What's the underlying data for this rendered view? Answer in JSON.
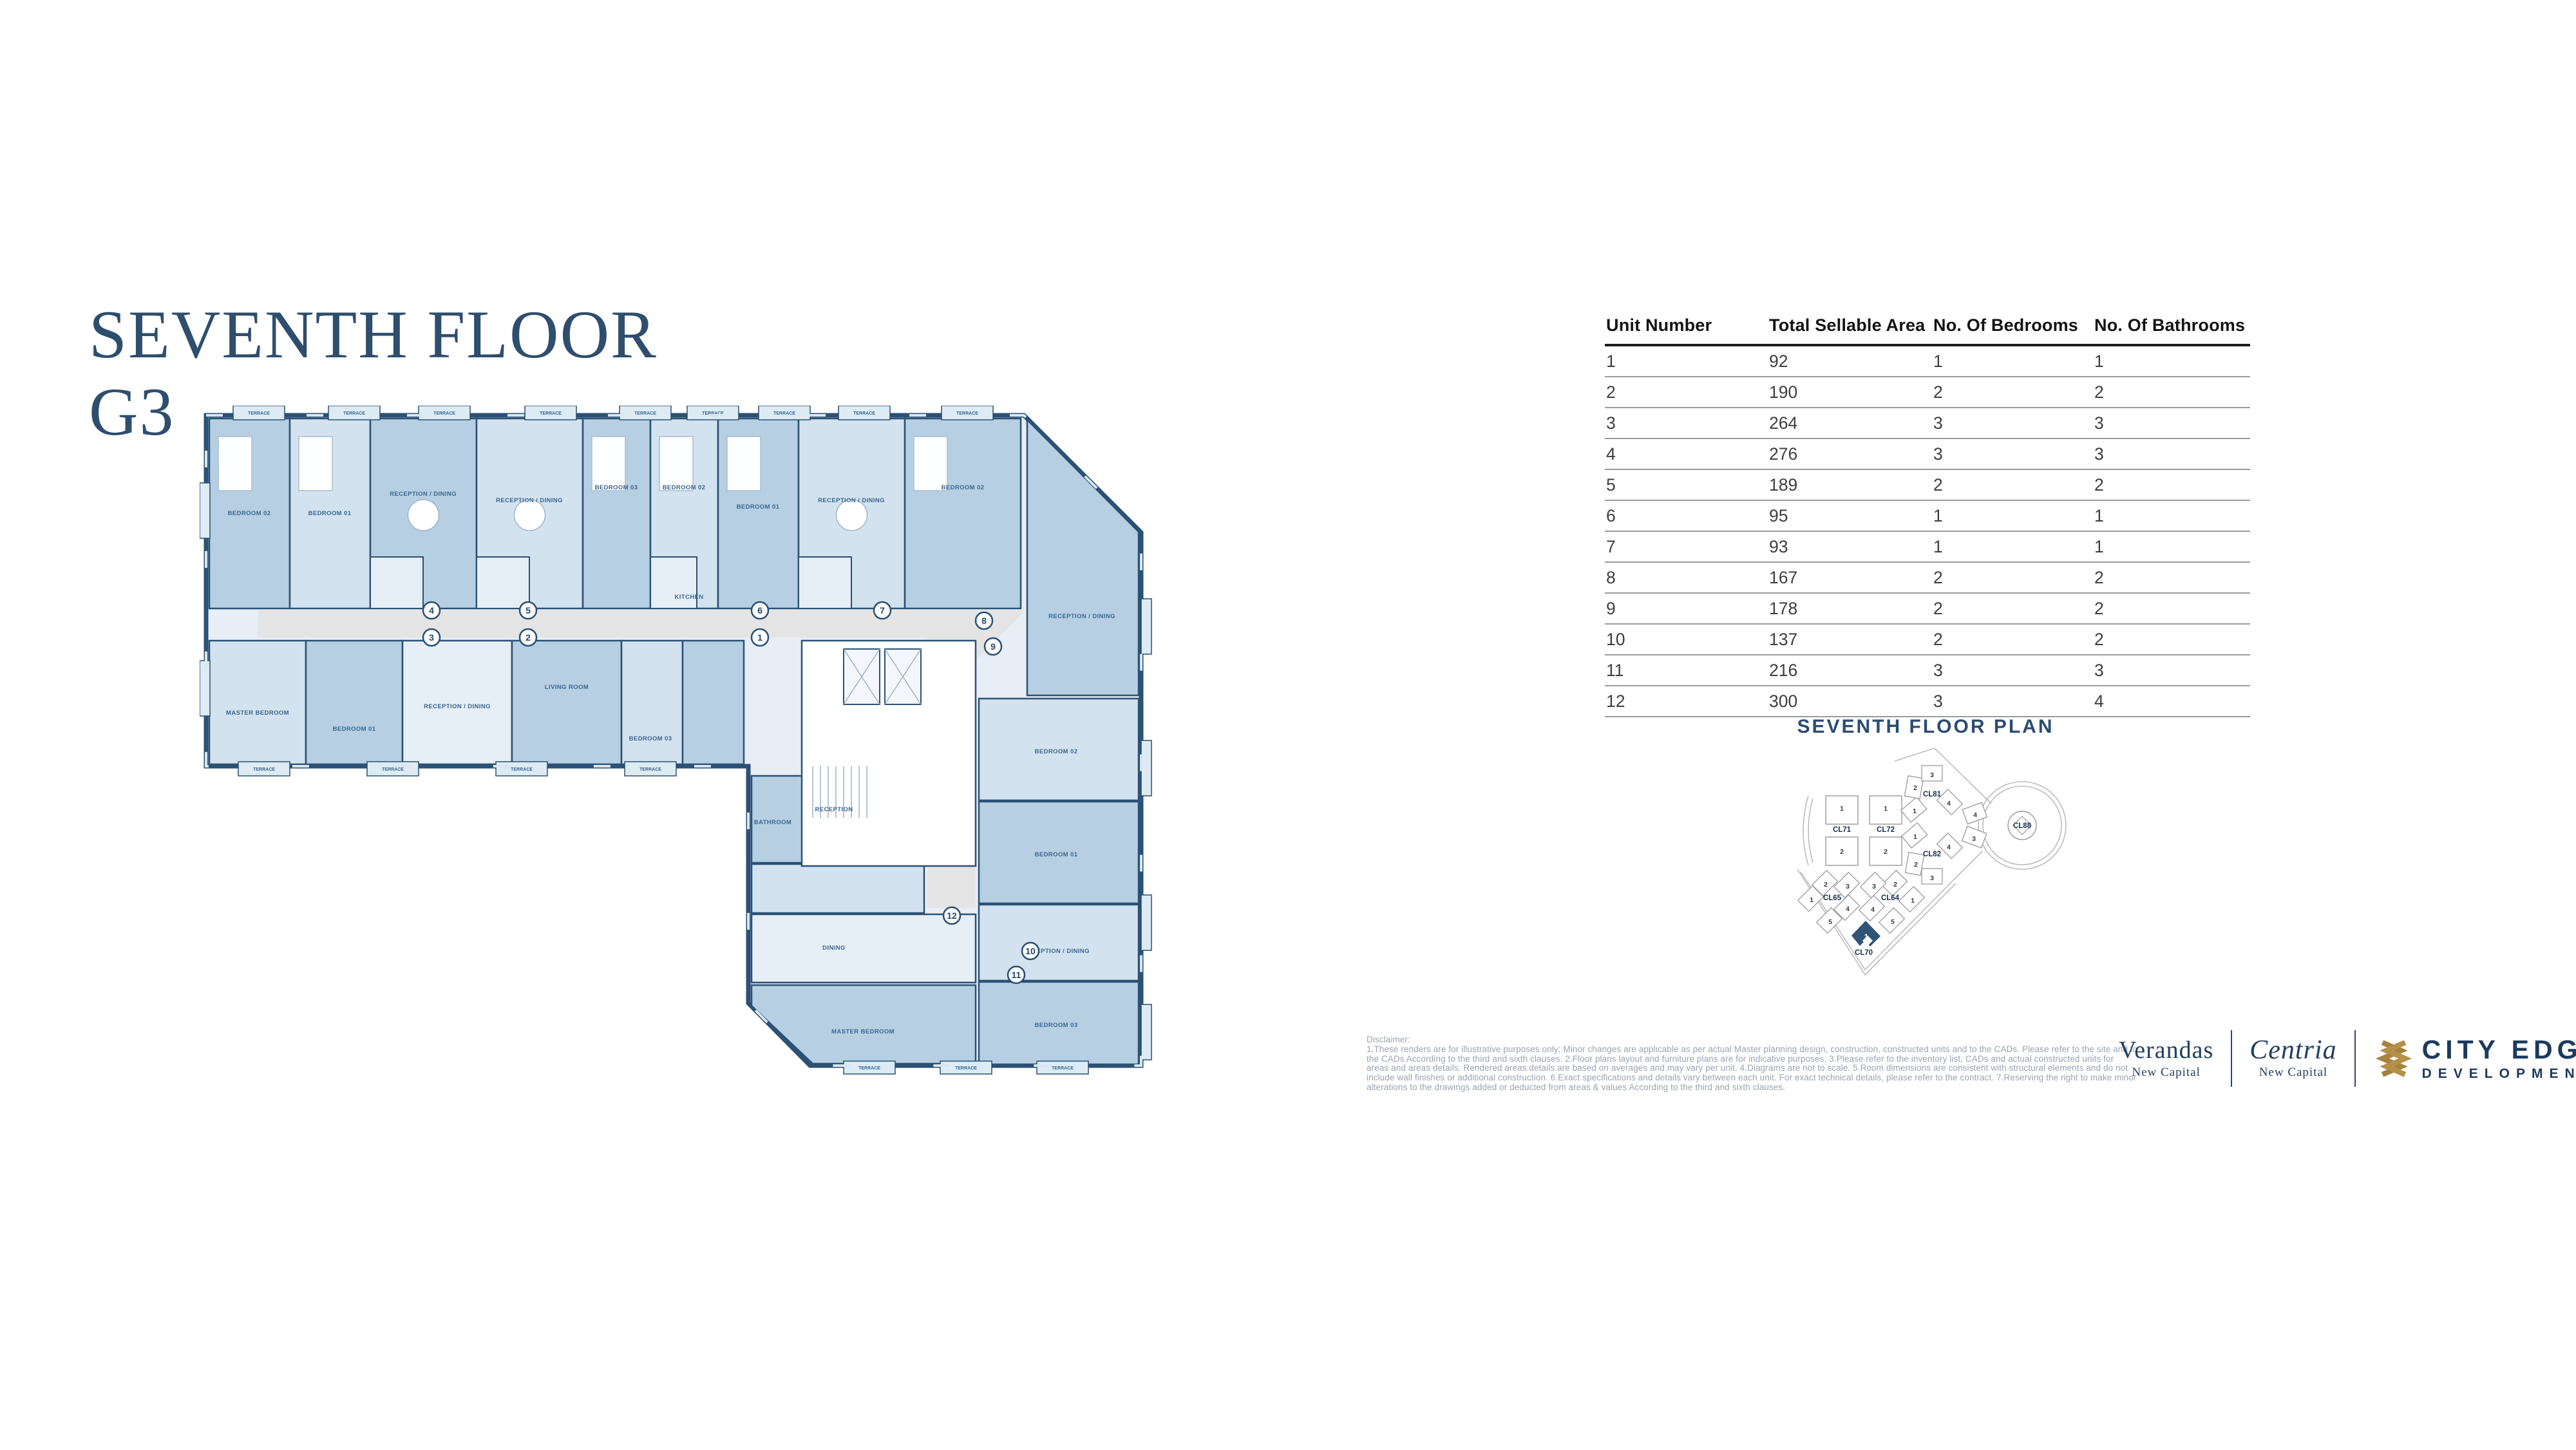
{
  "page": {
    "title_line1": "SEVENTH FLOOR",
    "title_line2": "G3"
  },
  "table": {
    "columns": [
      "Unit Number",
      "Total Sellable Area",
      "No. Of Bedrooms",
      "No. Of Bathrooms"
    ],
    "rows": [
      [
        "1",
        "92",
        "1",
        "1"
      ],
      [
        "2",
        "190",
        "2",
        "2"
      ],
      [
        "3",
        "264",
        "3",
        "3"
      ],
      [
        "4",
        "276",
        "3",
        "3"
      ],
      [
        "5",
        "189",
        "2",
        "2"
      ],
      [
        "6",
        "95",
        "1",
        "1"
      ],
      [
        "7",
        "93",
        "1",
        "1"
      ],
      [
        "8",
        "167",
        "2",
        "2"
      ],
      [
        "9",
        "178",
        "2",
        "2"
      ],
      [
        "10",
        "137",
        "2",
        "2"
      ],
      [
        "11",
        "216",
        "3",
        "3"
      ],
      [
        "12",
        "300",
        "3",
        "4"
      ]
    ]
  },
  "plan": {
    "unit_markers": [
      "1",
      "2",
      "3",
      "4",
      "5",
      "6",
      "7",
      "8",
      "9",
      "10",
      "11",
      "12"
    ],
    "terrace_label": "TERRACE",
    "room_labels": [
      "BEDROOM 02",
      "BEDROOM 01",
      "RECEPTION / DINING",
      "RECEPTION / DINING",
      "BEDROOM 03",
      "BEDROOM 02",
      "BEDROOM 01",
      "RECEPTION / DINING",
      "BEDROOM 02",
      "RECEPTION / DINING",
      "MASTER BEDROOM",
      "BEDROOM 01",
      "RECEPTION / DINING",
      "LIVING ROOM",
      "BEDROOM 03",
      "KITCHEN",
      "BATHROOM",
      "RECEPTION",
      "DINING",
      "MASTER BEDROOM",
      "BEDROOM 02",
      "BEDROOM 01",
      "RECEPTION / DINING",
      "BEDROOM 03"
    ]
  },
  "keymap": {
    "heading": "SEVENTH FLOOR PLAN",
    "clusters": [
      {
        "id": "CL71",
        "units": [
          "1",
          "2"
        ]
      },
      {
        "id": "CL72",
        "units": [
          "1",
          "2"
        ]
      },
      {
        "id": "CL81",
        "units": [
          "1",
          "2",
          "3",
          "4"
        ]
      },
      {
        "id": "CL82",
        "units": [
          "1",
          "2",
          "3",
          "4"
        ]
      },
      {
        "id": "CL88",
        "units": [
          "3",
          "4"
        ]
      },
      {
        "id": "CL65",
        "units": [
          "1",
          "2",
          "3",
          "4",
          "5"
        ]
      },
      {
        "id": "CL64",
        "units": [
          "1",
          "2",
          "3",
          "4",
          "5"
        ]
      },
      {
        "id": "CL70",
        "units": [
          "1"
        ],
        "highlighted": true
      }
    ]
  },
  "disclaimer": {
    "label": "Disclaimer:",
    "text": "1.These renders are for illustrative purposes only; Minor changes are applicable as per actual Master planning design, construction, constructed units and to the CADs. Please refer to the site and to the CADs According to the third and sixth clauses. 2.Floor plans layout and furniture plans are for indicative purposes. 3.Please refer to the inventory list, CADs and actual constructed units for areas and areas details. Rendered areas details are based on averages and may vary per unit. 4.Diagrams are not to scale. 5.Room dimensions are consistent with structural elements and do not include wall finishes or additional construction. 6.Exact specifications and details vary between each unit. For exact technical details, please refer to the contract. 7.Reserving the right to make minor alterations to the drawings added or deducted from areas & values According to the third and sixth clauses."
  },
  "logos": {
    "verandas": {
      "name": "Verandas",
      "subtitle": "New Capital"
    },
    "centria": {
      "name": "Centria",
      "subtitle": "New Capital"
    },
    "cityedge": {
      "line1": "CITY EDGE",
      "line2": "DEVELOPMENTS"
    }
  },
  "colors": {
    "title_navy": "#2e4e6d",
    "plan_wall": "#2b5174",
    "room_medium": "#b6cfe2",
    "room_light": "#d3e2ef",
    "room_pale": "#e6eef6",
    "corridor_gray": "#e4e4e4",
    "keymap_highlight": "#2e5578",
    "brand_navy": "#1c3a5e",
    "brand_gold": "#a7823e",
    "disclaimer_gray": "#9aa2b0"
  }
}
